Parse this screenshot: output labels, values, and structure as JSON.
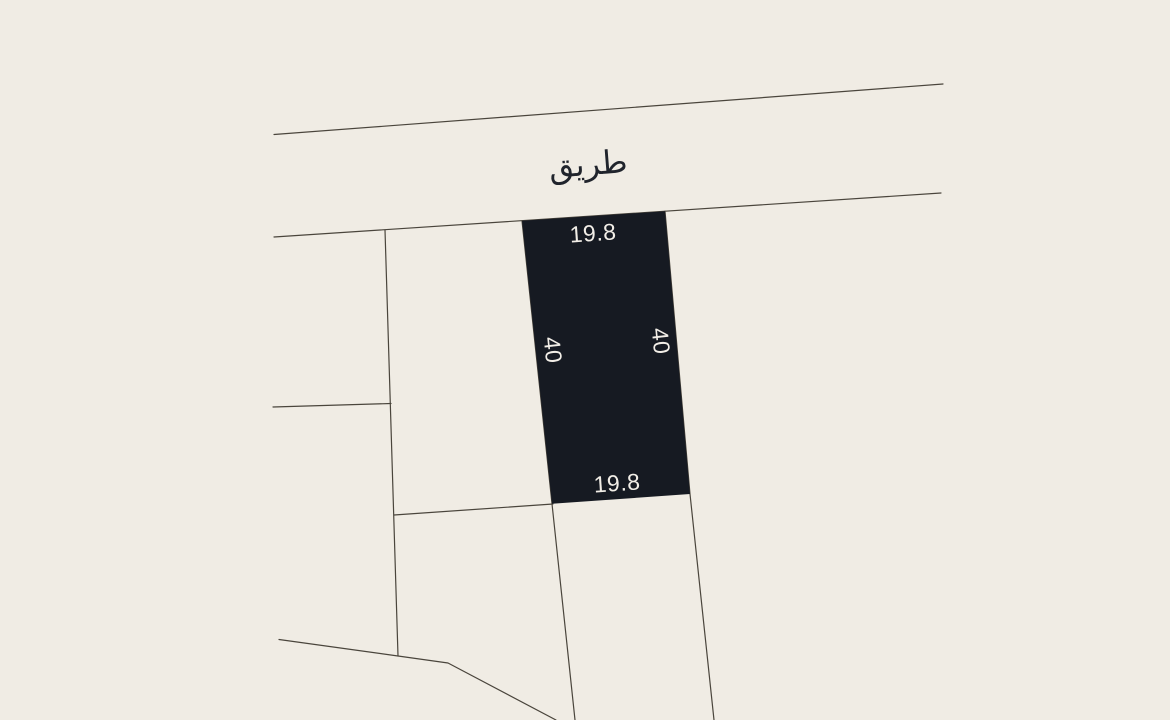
{
  "colors": {
    "background": "#f0ece4",
    "line": "#4a453c",
    "parcel_fill": "#161a22",
    "label_light": "#f2eee7",
    "label_dark": "#20242c"
  },
  "road": {
    "label": "طريق"
  },
  "parcel": {
    "top_width": "19.8",
    "bottom_width": "19.8",
    "left_length": "40",
    "right_length": "40"
  }
}
